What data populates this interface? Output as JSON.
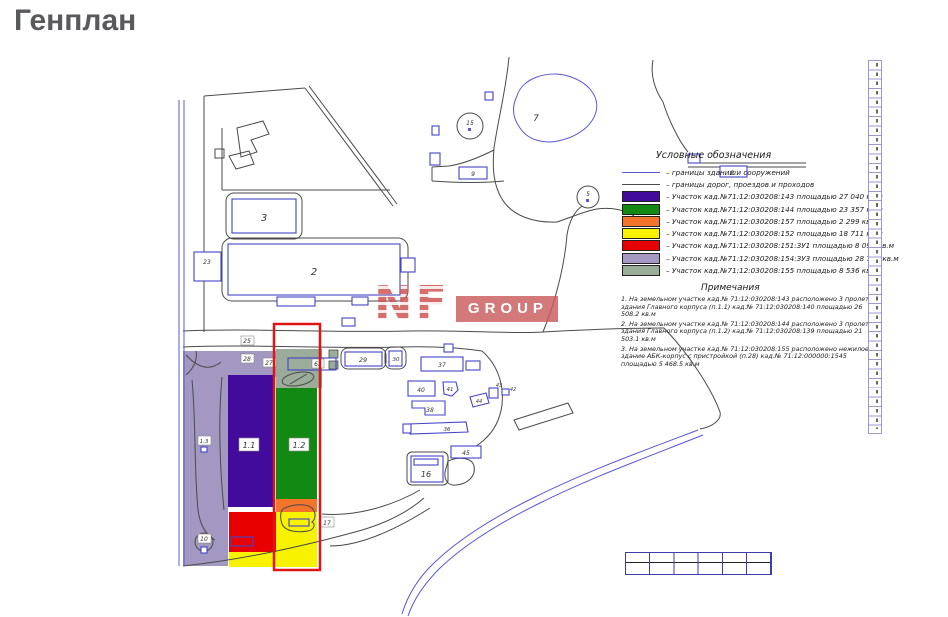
{
  "page": {
    "title": "Генплан"
  },
  "watermark": {
    "nf": "NF",
    "group": "GROUP"
  },
  "colors": {
    "purple": "#430b9c",
    "green": "#128912",
    "orange": "#f4742c",
    "yellow": "#f6f200",
    "red": "#e80000",
    "lavender": "#a298c2",
    "sage": "#9bac9b",
    "selection": "#dd1515",
    "building": "#4444c8",
    "road": "#4a4a4a",
    "water": "#5858d8"
  },
  "legend": {
    "title": "Условные обозначения",
    "lines": [
      {
        "color": "#5858d8",
        "label": "– границы зданий и сооружений"
      },
      {
        "color": "#4a4a4a",
        "label": "– границы дорог, проездов и проходов"
      }
    ],
    "items": [
      {
        "color": "#430b9c",
        "label": "– Участок кад.№71:12:030208:143 площадью 27 040 кв.м"
      },
      {
        "color": "#128912",
        "label": "– Участок кад.№71:12:030208:144 площадью 23 357 кв.м"
      },
      {
        "color": "#f4742c",
        "label": "– Участок кад.№71:12:030208:157 площадью 2 299 кв.м"
      },
      {
        "color": "#f6f200",
        "label": "– Участок кад.№71:12:030208:152 площадью 18 711 кв.м"
      },
      {
        "color": "#e80000",
        "label": "– Участок кад.№71:12:030208:151:ЗУ1 площадью 8 096 кв.м"
      },
      {
        "color": "#a298c2",
        "label": "– Участок кад.№71:12:030208:154:ЗУ3 площадью 28 793 кв.м"
      },
      {
        "color": "#9bac9b",
        "label": "– Участок кад.№71:12:030208:155 площадью 8 536 кв.м"
      }
    ]
  },
  "notes": {
    "title": "Примечания",
    "items": [
      "1. На земельном участке кад.№ 71:12:030208:143 расположено 3 пролета здания Главного корпуса (п.1.1) кад.№ 71:12:030208:140 площадью 26 508.2 кв.м",
      "2. На земельном участке кад.№ 71:12:030208:144 расположено 3 пролета здания Главного корпуса (п.1.2) кад.№ 71:12:030208:139 площадью 21 503.1 кв.м",
      "3. На земельном участке кад.№ 71:12:030208:155 расположено нежилое здание АБК-корпус с пристройкой (п.28) кад.№ 71:12:000000:1545 площадью 5 468.5 кв.м"
    ]
  },
  "plan": {
    "labels": {
      "b2": "2",
      "b3": "3",
      "b23": "23",
      "pond": "7",
      "c15": "15",
      "c5": "5",
      "b9": "9",
      "b12": "12",
      "b29": "29",
      "b30": "30",
      "b37": "37",
      "b40": "40",
      "b41": "41",
      "b38": "38",
      "b36": "36",
      "b44": "44",
      "b43": "43",
      "b42": "42",
      "b45": "45",
      "b16": "16",
      "z11": "1.1",
      "z12": "1.2",
      "b25": "25",
      "b27": "27",
      "b28": "28",
      "b63": "63",
      "b17": "17",
      "b10": "10",
      "b13": "1.3"
    }
  }
}
